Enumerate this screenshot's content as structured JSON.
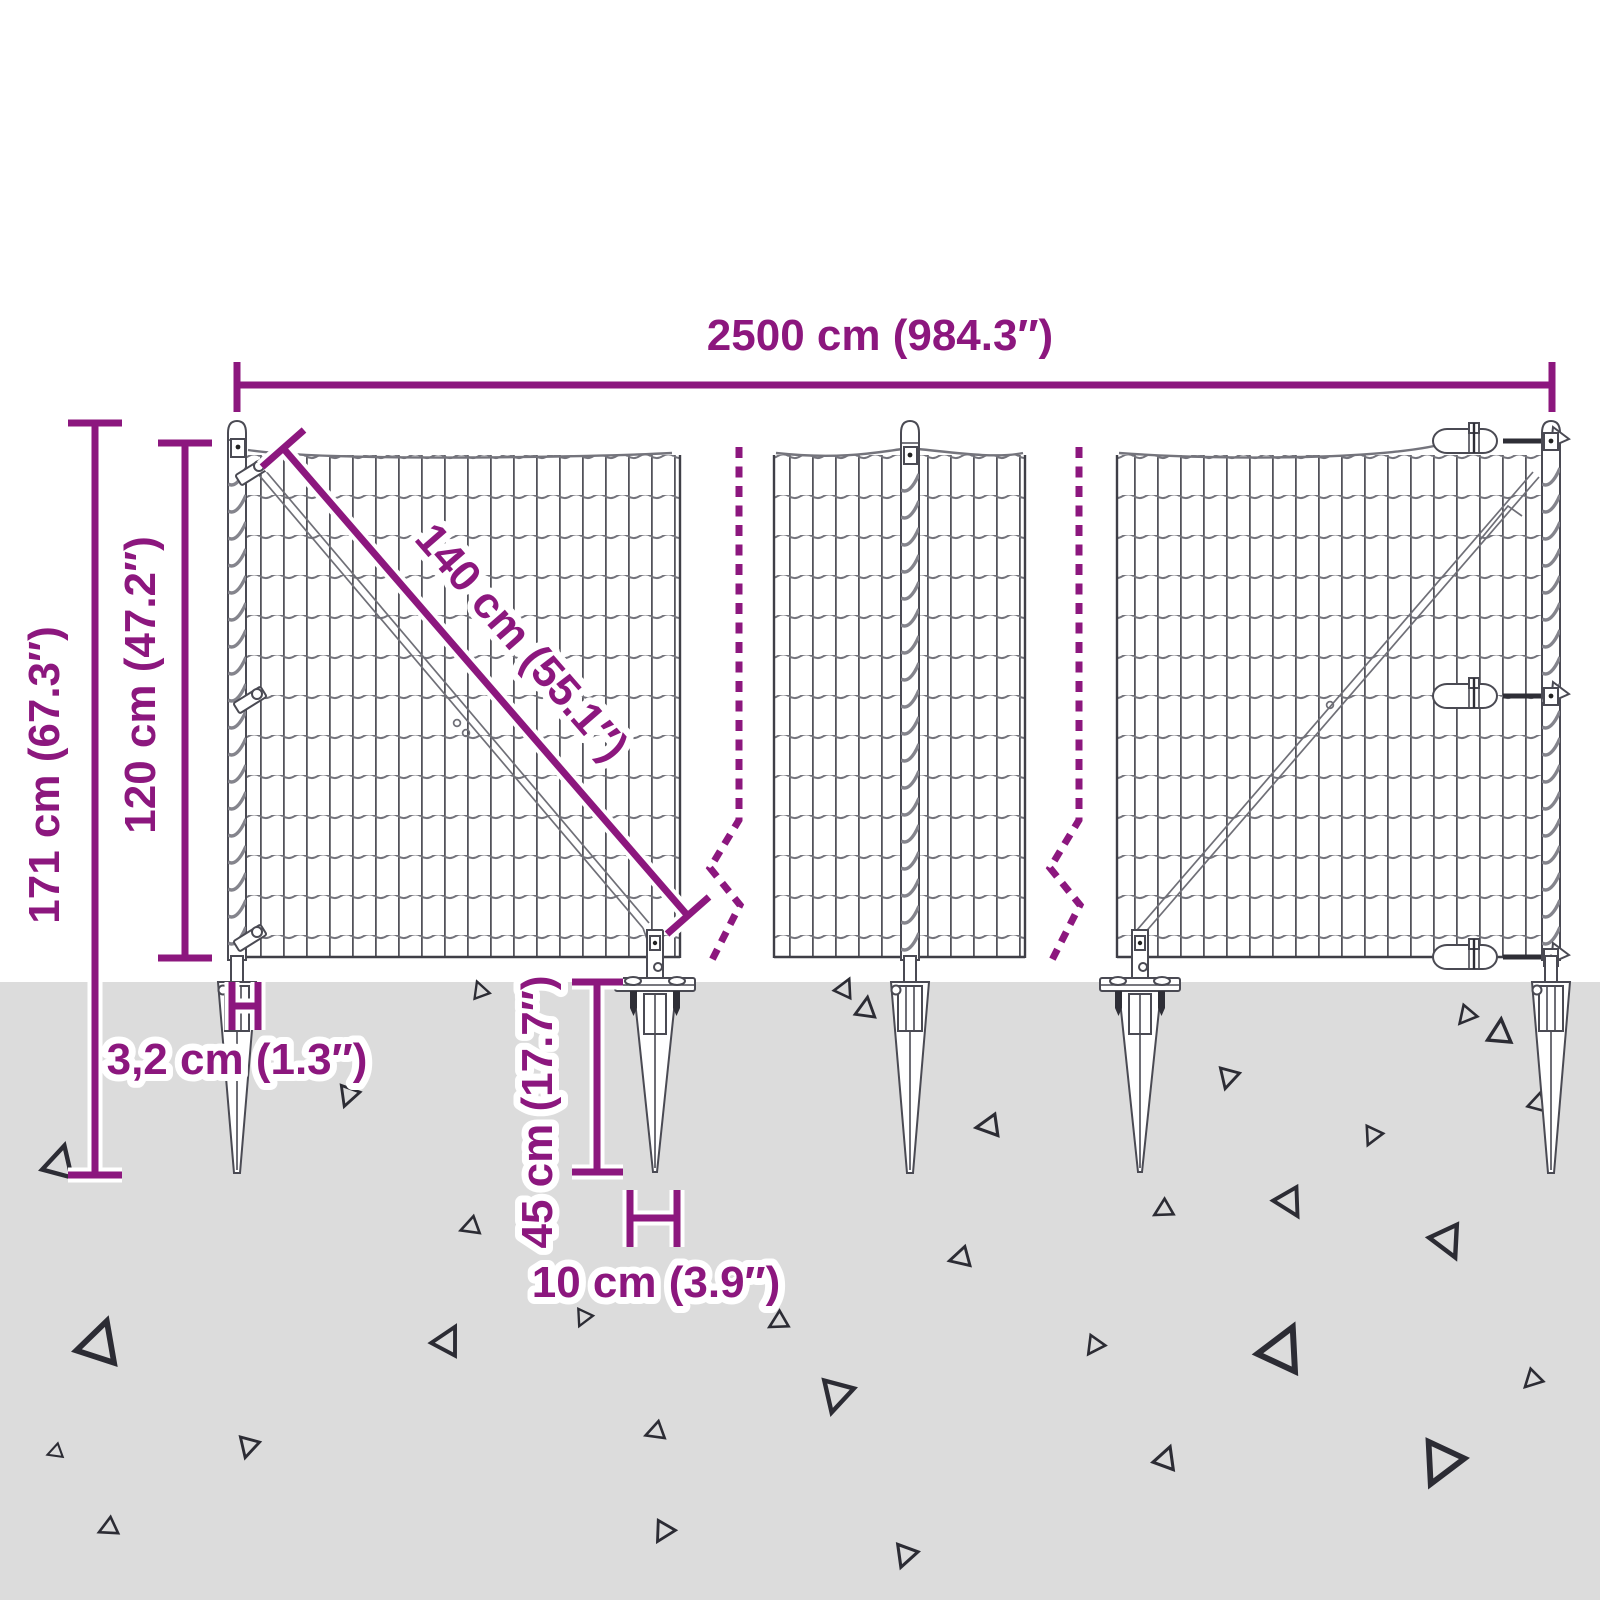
{
  "diagram": {
    "title": "Wire mesh fence with spike ground anchors - dimension diagram",
    "labels": {
      "total_width": "2500 cm (984.3″)",
      "overall_height": "171 cm (67.3″)",
      "fence_height": "120 cm (47.2″)",
      "brace_length": "140 cm (55.1″)",
      "post_width": "3,2 cm (1.3″)",
      "anchor_depth": "45 cm (17.7″)",
      "anchor_width": "10 cm (3.9″)"
    },
    "colors": {
      "accent": "#8C177E",
      "ground": "#DCDCDC",
      "line": "#3F3F47",
      "background": "#FFFFFF"
    }
  }
}
